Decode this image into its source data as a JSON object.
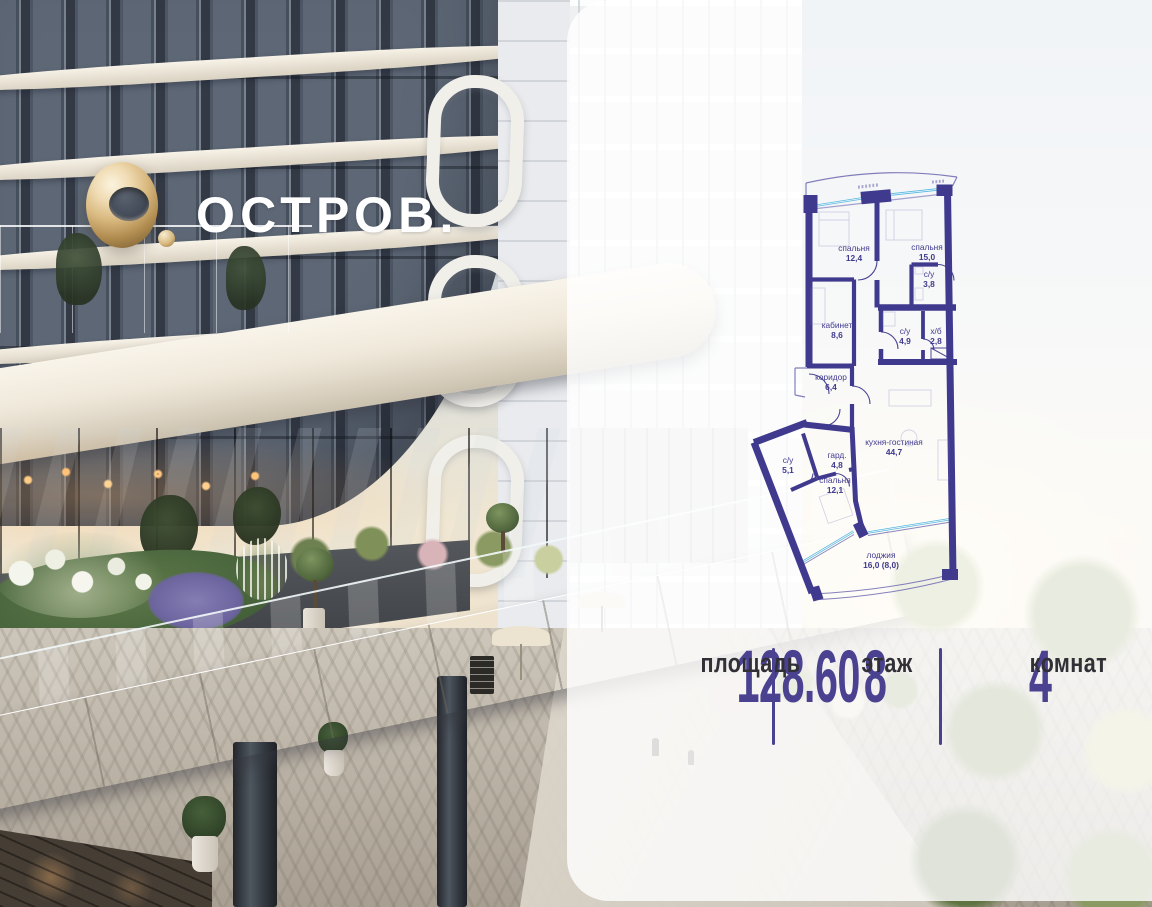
{
  "brand": {
    "name": "ОСТРОВ."
  },
  "floorplan": {
    "rooms": {
      "bedroom1": {
        "name": "спальня",
        "area": "12,4"
      },
      "bedroom2": {
        "name": "спальня",
        "area": "15,0"
      },
      "bath1": {
        "name": "с/у",
        "area": "3,8"
      },
      "office": {
        "name": "кабинет",
        "area": "8,6"
      },
      "bath2": {
        "name": "с/у",
        "area": "4,9"
      },
      "utility": {
        "name": "х/б",
        "area": "2,8"
      },
      "corridor": {
        "name": "коридор",
        "area": "6,4"
      },
      "kitchen_living": {
        "name": "кухня-гостиная",
        "area": "44,7"
      },
      "bath3": {
        "name": "с/у",
        "area": "5,1"
      },
      "wardrobe": {
        "name": "гард.",
        "area": "4,8"
      },
      "bedroom3": {
        "name": "спальня",
        "area": "12,1"
      },
      "loggia": {
        "name": "лоджия",
        "area": "16,0 (8,0)"
      }
    },
    "colors": {
      "wall": "#403a8f",
      "glazing": "#58b7e0"
    }
  },
  "stats": {
    "area": {
      "value": "128.60",
      "label": "площадь"
    },
    "floor": {
      "value": "8",
      "label": "этаж"
    },
    "rooms": {
      "value": "4",
      "label": "комнат"
    }
  },
  "accent": "#4a4291"
}
